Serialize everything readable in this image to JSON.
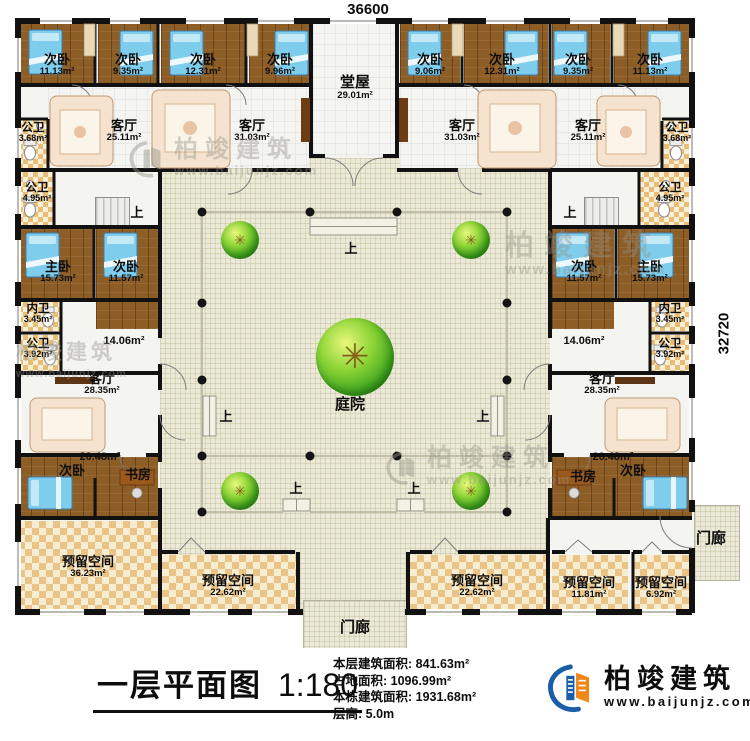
{
  "plan": {
    "dim_top": "36600",
    "dim_right": "32720",
    "up": "上",
    "courtyard": "庭院",
    "rooms": [
      {
        "name": "次卧",
        "area": "11.13m²"
      },
      {
        "name": "次卧",
        "area": "9.35m²"
      },
      {
        "name": "次卧",
        "area": "12.31m²"
      },
      {
        "name": "次卧",
        "area": "9.96m²"
      },
      {
        "name": "堂屋",
        "area": "29.01m²"
      },
      {
        "name": "次卧",
        "area": "9.06m²"
      },
      {
        "name": "次卧",
        "area": "12.31m²"
      },
      {
        "name": "次卧",
        "area": "9.35m²"
      },
      {
        "name": "次卧",
        "area": "11.13m²"
      },
      {
        "name": "客厅",
        "area": "25.11m²"
      },
      {
        "name": "客厅",
        "area": "31.03m²"
      },
      {
        "name": "客厅",
        "area": "31.03m²"
      },
      {
        "name": "客厅",
        "area": "25.11m²"
      },
      {
        "name": "公卫",
        "area": "3.68m²"
      },
      {
        "name": "公卫",
        "area": "3.68m²"
      },
      {
        "name": "公卫",
        "area": "4.95m²"
      },
      {
        "name": "公卫",
        "area": "4.95m²"
      },
      {
        "name": "主卧",
        "area": "15.73m²"
      },
      {
        "name": "次卧",
        "area": "11.57m²"
      },
      {
        "name": "次卧",
        "area": "11.57m²"
      },
      {
        "name": "主卧",
        "area": "15.73m²"
      },
      {
        "name": "内卫",
        "area": "3.45m²"
      },
      {
        "name": "内卫",
        "area": "3.45m²"
      },
      {
        "name": "公卫",
        "area": "3.92m²"
      },
      {
        "name": "公卫",
        "area": "3.92m²"
      },
      {
        "name": "",
        "area": "14.06m²"
      },
      {
        "name": "",
        "area": "14.06m²"
      },
      {
        "name": "客厅",
        "area": "28.35m²"
      },
      {
        "name": "客厅",
        "area": "28.35m²"
      },
      {
        "name": "",
        "area": "20.48m²"
      },
      {
        "name": "次卧",
        "area": ""
      },
      {
        "name": "书房",
        "area": ""
      },
      {
        "name": "",
        "area": "20.48m²"
      },
      {
        "name": "书房",
        "area": ""
      },
      {
        "name": "次卧",
        "area": ""
      },
      {
        "name": "预留空间",
        "area": "36.23m²"
      },
      {
        "name": "预留空间",
        "area": "22.62m²"
      },
      {
        "name": "预留空间",
        "area": "22.62m²"
      },
      {
        "name": "预留空间",
        "area": "11.81m²"
      },
      {
        "name": "预留空间",
        "area": "6.92m²"
      },
      {
        "name": "门廊",
        "area": ""
      },
      {
        "name": "门廊",
        "area": ""
      }
    ]
  },
  "titlebar": {
    "title": "一层平面图",
    "scale": "1:180",
    "stats": [
      {
        "label": "本层建筑面积:",
        "value": "841.63m²"
      },
      {
        "label": "占地面积:",
        "value": "1096.99m²"
      },
      {
        "label": "本栋建筑面积:",
        "value": "1931.68m²"
      },
      {
        "label": "层高:",
        "value": "5.0m"
      }
    ],
    "brand": {
      "name": "柏竣建筑",
      "url": "www.baijunjz.com"
    }
  },
  "watermark": {
    "name": "柏竣建筑",
    "url": "www.baijunjz.com"
  },
  "colors": {
    "wall": "#111111",
    "wood": "#8d5d26",
    "tile": "#e7bd77",
    "reserve": "#eac487",
    "courtyard": "#ebe9d7",
    "bed": "#7ecdec",
    "brand_blue": "#1a5ea8",
    "brand_orange": "#f08718"
  }
}
